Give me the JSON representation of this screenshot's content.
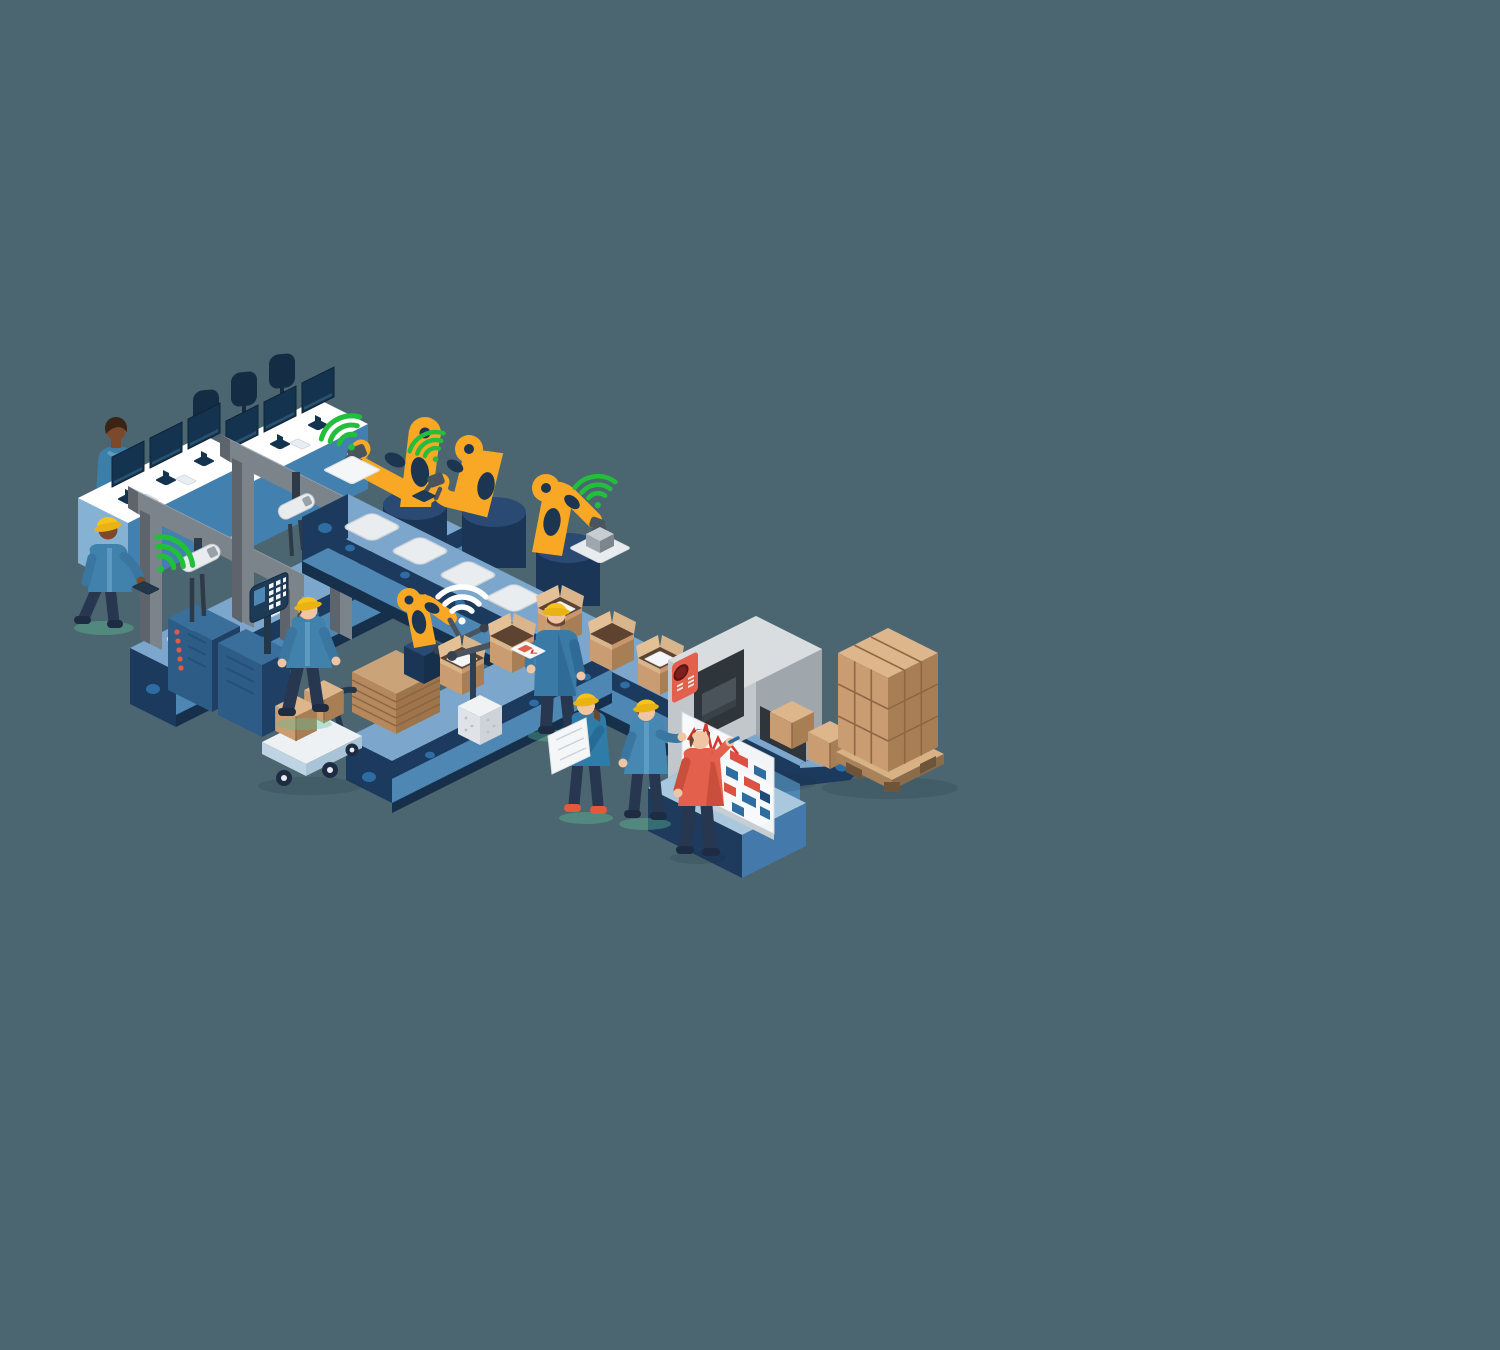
{
  "scene": {
    "title": "Smart factory automation isometric illustration",
    "background_color": "#4B6670",
    "labels": {
      "illustration": "Isometric smart factory with automated production line",
      "office_workstations": "Office desks with monitors and chairs",
      "office_worker": "Worker standing at office workstation",
      "supervisor_tablet": "Supervisor with hard hat holding connected tablet",
      "gantry_frames": "Gray gantry frames over electronics line",
      "tray_conveyor": "Conveyor with component trays",
      "overhead_gripper": "Overhead pick-and-place gripper",
      "server_racks": "Control server cabinets",
      "keypad_panel_blue": "Line control keypad with blue display",
      "keypad_panel_orange": "Line control keypad with orange key",
      "robotic_arm": "Industrial robotic arm",
      "main_conveyor": "Main production conveyor belt",
      "packing_conveyor": "Packing line conveyor",
      "packing_robot": "Box folding robot arm",
      "cardboard_stack": "Stack of flat cardboard sheets",
      "hand_trolley": "Trolley with cardboard boxes",
      "box_lifter": "Box lifting pole tool",
      "walking_worker": "Worker walking along the line",
      "junction_worker": "Worker checking tablet at conveyor junction",
      "open_box": "Open cardboard box",
      "closed_box": "Closed cardboard box",
      "scanning_machine": "Automated scanning machine over conveyor",
      "machine_panel": "Machine control panel with stop button",
      "pallet_load": "Palletized stack of boxes",
      "kanban_board": "Production kanban board with chart and notes",
      "engineer_blueprint": "Engineer holding blueprint sheet",
      "worker_gesturing": "Worker discussing at the board",
      "manager_board": "Manager in orange shirt writing on board",
      "wifi_green": "Green wireless signal icon",
      "wifi_white": "White wireless signal icon"
    },
    "palette": {
      "background": "#4B6670",
      "conveyor_top": "#7CA6CB",
      "conveyor_body": "#4E86B4",
      "conveyor_dark": "#1C3A5E",
      "robot_yellow": "#F9A825",
      "safety_hat_yellow": "#F6C21B",
      "wifi_green": "#22BE3C",
      "cardboard_light": "#DDB68C",
      "cardboard_mid": "#C99C72",
      "cardboard_dark": "#A87E55",
      "machine_gray": "#C2C7CC",
      "gantry_gray": "#7B838B",
      "alert_red": "#E2604C",
      "note_blue": "#2F6DA0",
      "chart_red": "#D4382E",
      "jacket_blue": "#4182AC",
      "pants_navy": "#26374F",
      "board_white": "#FBFCFD"
    },
    "counts": {
      "people": 7,
      "large_robot_arms": 3,
      "packing_robot_arms": 1,
      "overhead_grippers": 2,
      "green_wifi_signals": 4,
      "white_wifi_signals": 1,
      "desk_monitors": 6,
      "conveyor_lines": 3,
      "pallet_boxes_visible_faces": "3x3 grid"
    }
  }
}
